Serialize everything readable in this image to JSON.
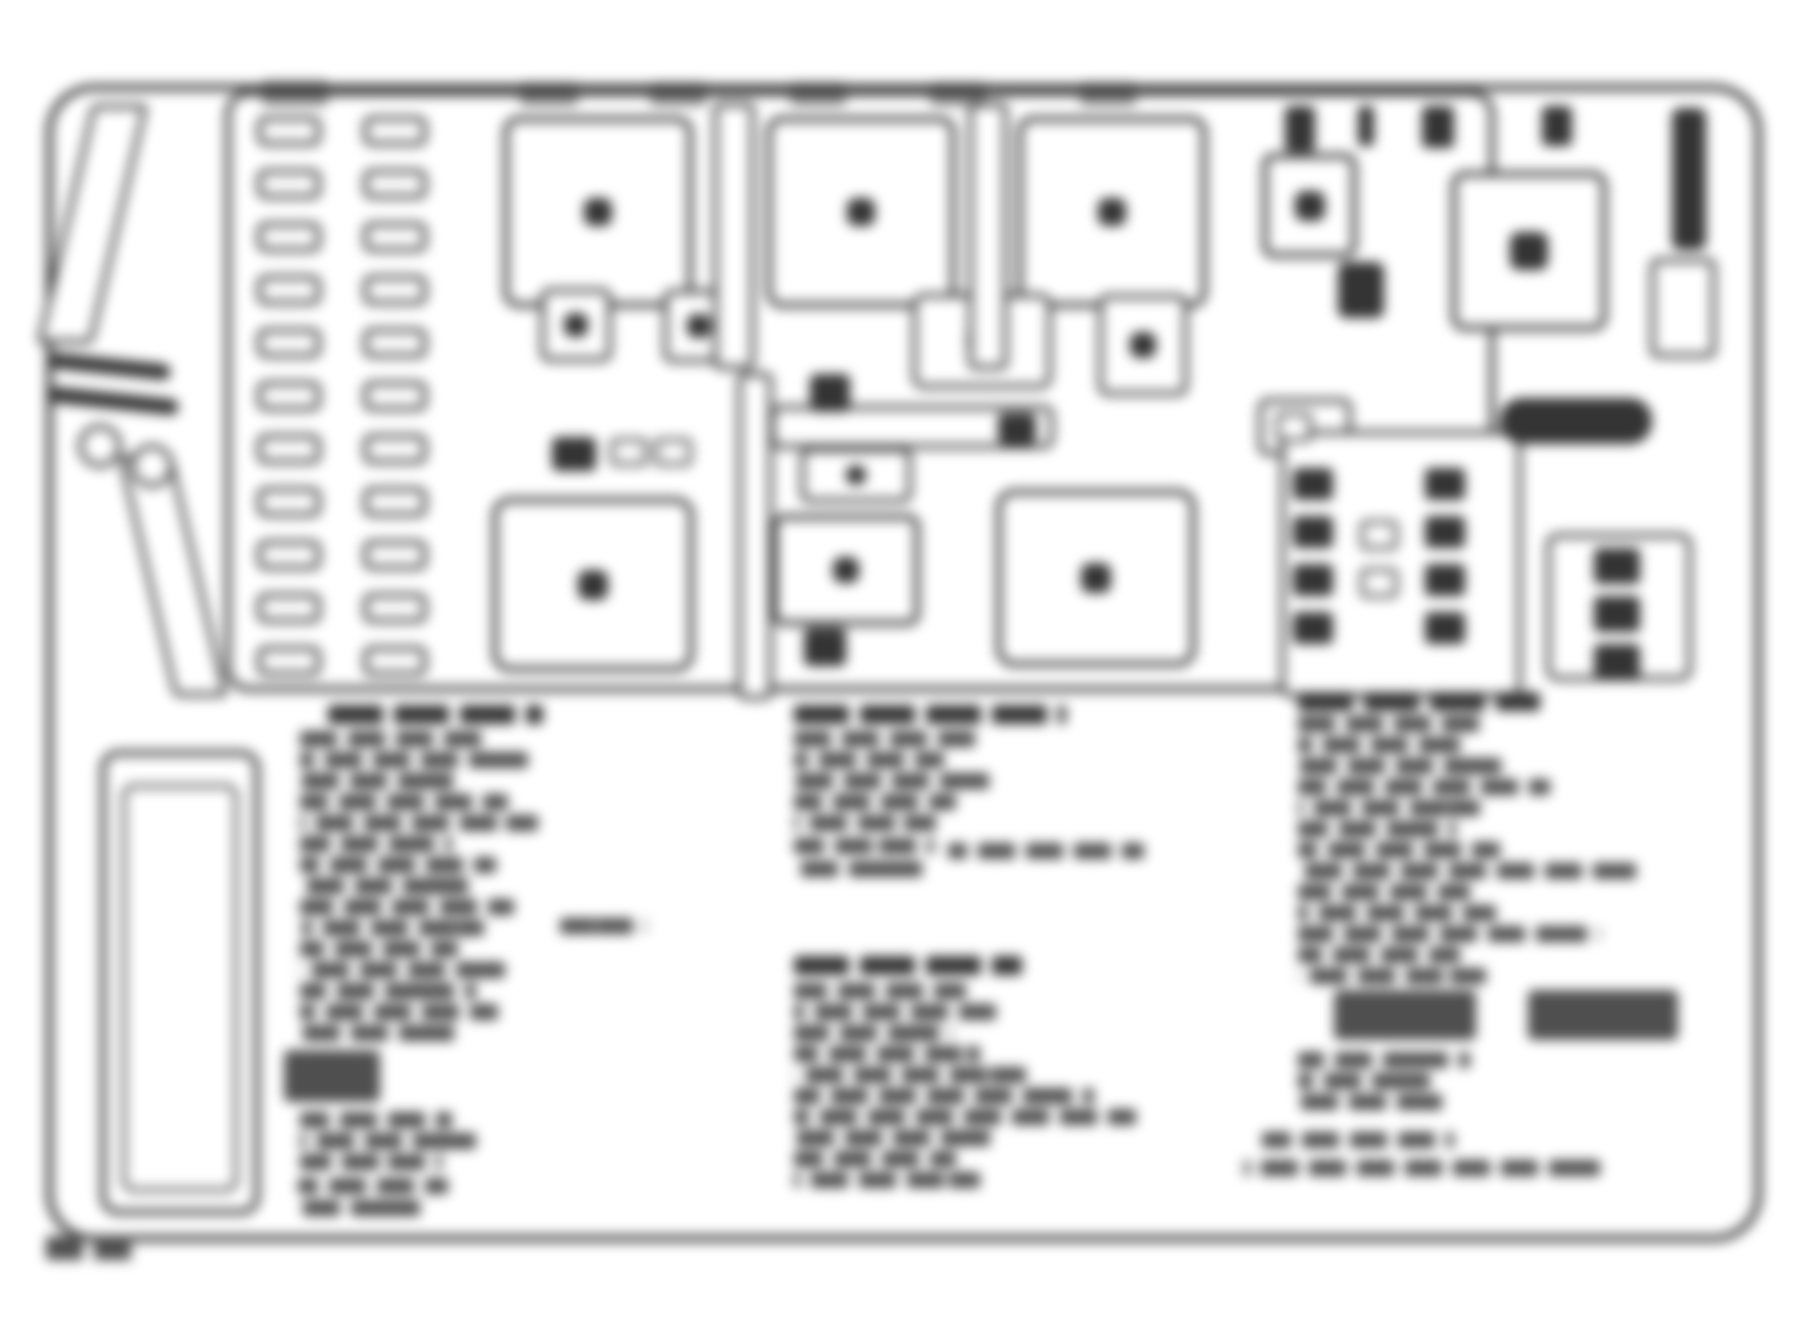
{
  "meta": {
    "description": "Blurred scanned diagram of an underhood fuse/relay block with three illegible legend text columns",
    "canvas": {
      "w": 1811,
      "h": 1331
    },
    "colors": {
      "background": "#ffffff",
      "stroke": "#3c3c3c",
      "dark": "#343434",
      "text": "#4f4f4f"
    },
    "blur_px": 6
  },
  "outer_box": {
    "x": 46,
    "y": 84,
    "w": 1716,
    "h": 1158,
    "r": 48,
    "bw": 7
  },
  "inner_box": {
    "x": 225,
    "y": 90,
    "w": 1270,
    "h": 602,
    "r": 24,
    "bw": 6
  },
  "left_panel_outer": {
    "x": 100,
    "y": 750,
    "w": 160,
    "h": 465,
    "r": 18,
    "bw": 6
  },
  "left_panel_inner": {
    "x": 122,
    "y": 784,
    "w": 116,
    "h": 408,
    "r": 12,
    "bw": 4
  },
  "wedges": [
    {
      "x": 92,
      "y": 104,
      "w": 56,
      "h": 240,
      "r": 6,
      "bw": 5,
      "skew": -13
    },
    {
      "x": 118,
      "y": 455,
      "w": 54,
      "h": 242,
      "r": 6,
      "bw": 5,
      "skew": 13
    }
  ],
  "bolt_rings": [
    {
      "cx": 100,
      "cy": 446,
      "r": 22
    },
    {
      "cx": 152,
      "cy": 466,
      "r": 22
    }
  ],
  "connector_bars": [
    {
      "x": 50,
      "y": 352,
      "w": 122,
      "h": 16,
      "r": 8,
      "rot": 6
    },
    {
      "x": 48,
      "y": 386,
      "w": 132,
      "h": 16,
      "r": 8,
      "rot": 6
    }
  ],
  "fuse_panel": {
    "left_x": 257,
    "right_x": 363,
    "w": 64,
    "h": 30,
    "r": 9,
    "bw": 5,
    "rows": [
      116,
      169,
      222,
      275,
      328,
      381,
      434,
      487,
      540,
      593,
      646
    ]
  },
  "relays": [
    {
      "x": 503,
      "y": 116,
      "w": 190,
      "h": 192,
      "r": 16,
      "bw": 6,
      "dot": 28
    },
    {
      "x": 766,
      "y": 116,
      "w": 190,
      "h": 192,
      "r": 16,
      "bw": 6,
      "dot": 28
    },
    {
      "x": 1017,
      "y": 116,
      "w": 190,
      "h": 192,
      "r": 16,
      "bw": 6,
      "dot": 28
    },
    {
      "x": 1262,
      "y": 153,
      "w": 95,
      "h": 105,
      "r": 12,
      "bw": 6,
      "dot": 30
    },
    {
      "x": 1451,
      "y": 171,
      "w": 156,
      "h": 160,
      "r": 14,
      "bw": 6,
      "dot": 38
    },
    {
      "x": 540,
      "y": 288,
      "w": 72,
      "h": 74,
      "r": 10,
      "bw": 5,
      "dot": 24
    },
    {
      "x": 663,
      "y": 289,
      "w": 72,
      "h": 74,
      "r": 10,
      "bw": 5,
      "dot": 24
    },
    {
      "x": 912,
      "y": 293,
      "w": 140,
      "h": 96,
      "r": 12,
      "bw": 5,
      "dot": 30
    },
    {
      "x": 1098,
      "y": 294,
      "w": 90,
      "h": 102,
      "r": 10,
      "bw": 5,
      "dot": 26
    },
    {
      "x": 800,
      "y": 447,
      "w": 112,
      "h": 56,
      "r": 10,
      "bw": 5,
      "dot": 20
    },
    {
      "x": 772,
      "y": 514,
      "w": 148,
      "h": 112,
      "r": 12,
      "bw": 6,
      "dot": 26
    },
    {
      "x": 492,
      "y": 497,
      "w": 202,
      "h": 175,
      "r": 18,
      "bw": 6,
      "dot": 30
    },
    {
      "x": 996,
      "y": 489,
      "w": 200,
      "h": 178,
      "r": 18,
      "bw": 6,
      "dot": 30
    }
  ],
  "panel_boxes": [
    {
      "x": 713,
      "y": 102,
      "w": 42,
      "h": 268,
      "r": 8,
      "bw": 5
    },
    {
      "x": 968,
      "y": 102,
      "w": 40,
      "h": 268,
      "r": 8,
      "bw": 5
    },
    {
      "x": 737,
      "y": 372,
      "w": 36,
      "h": 328,
      "r": 8,
      "bw": 5
    },
    {
      "x": 770,
      "y": 405,
      "w": 284,
      "h": 44,
      "r": 10,
      "bw": 5
    },
    {
      "x": 1258,
      "y": 398,
      "w": 94,
      "h": 58,
      "r": 10,
      "bw": 5
    },
    {
      "x": 1280,
      "y": 430,
      "w": 242,
      "h": 268,
      "r": 12,
      "bw": 5
    },
    {
      "x": 1546,
      "y": 533,
      "w": 146,
      "h": 148,
      "r": 12,
      "bw": 5
    }
  ],
  "small_cavities": [
    {
      "x": 610,
      "y": 438,
      "w": 38,
      "h": 28,
      "r": 6,
      "bw": 4
    },
    {
      "x": 654,
      "y": 438,
      "w": 38,
      "h": 28,
      "r": 6,
      "bw": 4
    },
    {
      "x": 1360,
      "y": 520,
      "w": 38,
      "h": 30,
      "r": 6,
      "bw": 4
    },
    {
      "x": 1360,
      "y": 568,
      "w": 38,
      "h": 30,
      "r": 6,
      "bw": 4
    },
    {
      "x": 1650,
      "y": 258,
      "w": 66,
      "h": 100,
      "r": 8,
      "bw": 5
    },
    {
      "x": 1276,
      "y": 412,
      "w": 36,
      "h": 30,
      "r": 5,
      "bw": 4
    }
  ],
  "dark_marks": [
    {
      "x": 552,
      "y": 437,
      "w": 44,
      "h": 34,
      "r": 6
    },
    {
      "x": 810,
      "y": 374,
      "w": 40,
      "h": 38,
      "r": 6
    },
    {
      "x": 998,
      "y": 413,
      "w": 38,
      "h": 31,
      "r": 6
    },
    {
      "x": 804,
      "y": 628,
      "w": 42,
      "h": 38,
      "r": 6
    },
    {
      "x": 1338,
      "y": 262,
      "w": 46,
      "h": 56,
      "r": 8
    },
    {
      "x": 1500,
      "y": 398,
      "w": 152,
      "h": 46,
      "r": 22
    },
    {
      "x": 1672,
      "y": 108,
      "w": 34,
      "h": 142,
      "r": 8
    },
    {
      "x": 1285,
      "y": 106,
      "w": 30,
      "h": 46,
      "r": 5
    },
    {
      "x": 1358,
      "y": 106,
      "w": 16,
      "h": 40,
      "r": 4
    },
    {
      "x": 1422,
      "y": 106,
      "w": 32,
      "h": 42,
      "r": 5
    },
    {
      "x": 1542,
      "y": 106,
      "w": 30,
      "h": 40,
      "r": 5
    },
    {
      "x": 1293,
      "y": 468,
      "w": 40,
      "h": 32,
      "r": 5
    },
    {
      "x": 1293,
      "y": 516,
      "w": 40,
      "h": 32,
      "r": 5
    },
    {
      "x": 1293,
      "y": 564,
      "w": 40,
      "h": 32,
      "r": 5
    },
    {
      "x": 1293,
      "y": 612,
      "w": 40,
      "h": 32,
      "r": 5
    },
    {
      "x": 1425,
      "y": 468,
      "w": 40,
      "h": 32,
      "r": 5
    },
    {
      "x": 1425,
      "y": 516,
      "w": 40,
      "h": 32,
      "r": 5
    },
    {
      "x": 1425,
      "y": 564,
      "w": 40,
      "h": 32,
      "r": 5
    },
    {
      "x": 1425,
      "y": 612,
      "w": 40,
      "h": 32,
      "r": 5
    },
    {
      "x": 1594,
      "y": 548,
      "w": 46,
      "h": 36,
      "r": 5
    },
    {
      "x": 1594,
      "y": 596,
      "w": 46,
      "h": 36,
      "r": 5
    },
    {
      "x": 1594,
      "y": 644,
      "w": 46,
      "h": 36,
      "r": 5
    }
  ],
  "top_tabs": [
    {
      "x": 262,
      "y": 80,
      "w": 66,
      "h": 26,
      "r": 4
    },
    {
      "x": 520,
      "y": 82,
      "w": 58,
      "h": 24,
      "r": 4
    },
    {
      "x": 650,
      "y": 82,
      "w": 56,
      "h": 24,
      "r": 4
    },
    {
      "x": 790,
      "y": 82,
      "w": 56,
      "h": 24,
      "r": 4
    },
    {
      "x": 930,
      "y": 82,
      "w": 56,
      "h": 24,
      "r": 4
    },
    {
      "x": 1080,
      "y": 82,
      "w": 56,
      "h": 24,
      "r": 4
    }
  ],
  "legend": {
    "note": "three columns of blurred, illegible fuse-legend text",
    "columns": [
      {
        "name": "left",
        "heads": [
          [
            328,
            705,
            215
          ]
        ],
        "lines": [
          [
            300,
            731,
            185
          ],
          [
            300,
            752,
            228
          ],
          [
            300,
            773,
            162
          ],
          [
            300,
            794,
            208
          ],
          [
            300,
            815,
            238
          ],
          [
            300,
            836,
            152
          ],
          [
            300,
            857,
            196
          ],
          [
            300,
            878,
            172
          ],
          [
            300,
            899,
            214
          ],
          [
            302,
            920,
            182
          ],
          [
            560,
            918,
            86
          ],
          [
            300,
            941,
            158
          ],
          [
            300,
            962,
            205
          ],
          [
            300,
            983,
            176
          ],
          [
            300,
            1004,
            198
          ],
          [
            300,
            1025,
            162
          ],
          [
            300,
            1112,
            152
          ],
          [
            300,
            1133,
            176
          ],
          [
            300,
            1154,
            142
          ],
          [
            298,
            1178,
            150
          ],
          [
            295,
            1200,
            128
          ]
        ],
        "chunks": [
          [
            284,
            1050,
            96,
            52
          ]
        ]
      },
      {
        "name": "middle",
        "heads": [
          [
            794,
            705,
            272
          ],
          [
            794,
            956,
            228
          ]
        ],
        "lines": [
          [
            794,
            731,
            182
          ],
          [
            794,
            752,
            150
          ],
          [
            794,
            773,
            204
          ],
          [
            794,
            794,
            162
          ],
          [
            794,
            815,
            142
          ],
          [
            794,
            838,
            140
          ],
          [
            948,
            843,
            196
          ],
          [
            794,
            861,
            132
          ],
          [
            794,
            983,
            172
          ],
          [
            794,
            1004,
            202
          ],
          [
            794,
            1025,
            158
          ],
          [
            794,
            1046,
            186
          ],
          [
            794,
            1067,
            232
          ],
          [
            794,
            1088,
            300
          ],
          [
            794,
            1109,
            342
          ],
          [
            794,
            1130,
            204
          ],
          [
            794,
            1151,
            162
          ],
          [
            794,
            1172,
            186
          ]
        ],
        "chunks": []
      },
      {
        "name": "right",
        "heads": [
          [
            1298,
            692,
            242
          ]
        ],
        "lines": [
          [
            1298,
            716,
            192
          ],
          [
            1298,
            737,
            162
          ],
          [
            1298,
            758,
            212
          ],
          [
            1298,
            779,
            252
          ],
          [
            1298,
            800,
            182
          ],
          [
            1298,
            821,
            158
          ],
          [
            1298,
            842,
            202
          ],
          [
            1298,
            863,
            342
          ],
          [
            1298,
            884,
            172
          ],
          [
            1298,
            905,
            198
          ],
          [
            1298,
            926,
            302
          ],
          [
            1298,
            947,
            162
          ],
          [
            1298,
            968,
            188
          ],
          [
            1298,
            1052,
            172
          ],
          [
            1298,
            1073,
            132
          ],
          [
            1298,
            1094,
            152
          ],
          [
            1262,
            1132,
            192
          ],
          [
            1244,
            1160,
            356
          ]
        ],
        "chunks": [
          [
            1334,
            990,
            142,
            50
          ],
          [
            1528,
            990,
            150,
            50
          ]
        ]
      }
    ]
  },
  "caption_blur": {
    "x": 46,
    "y": 1236,
    "w": 92,
    "h": 24
  }
}
